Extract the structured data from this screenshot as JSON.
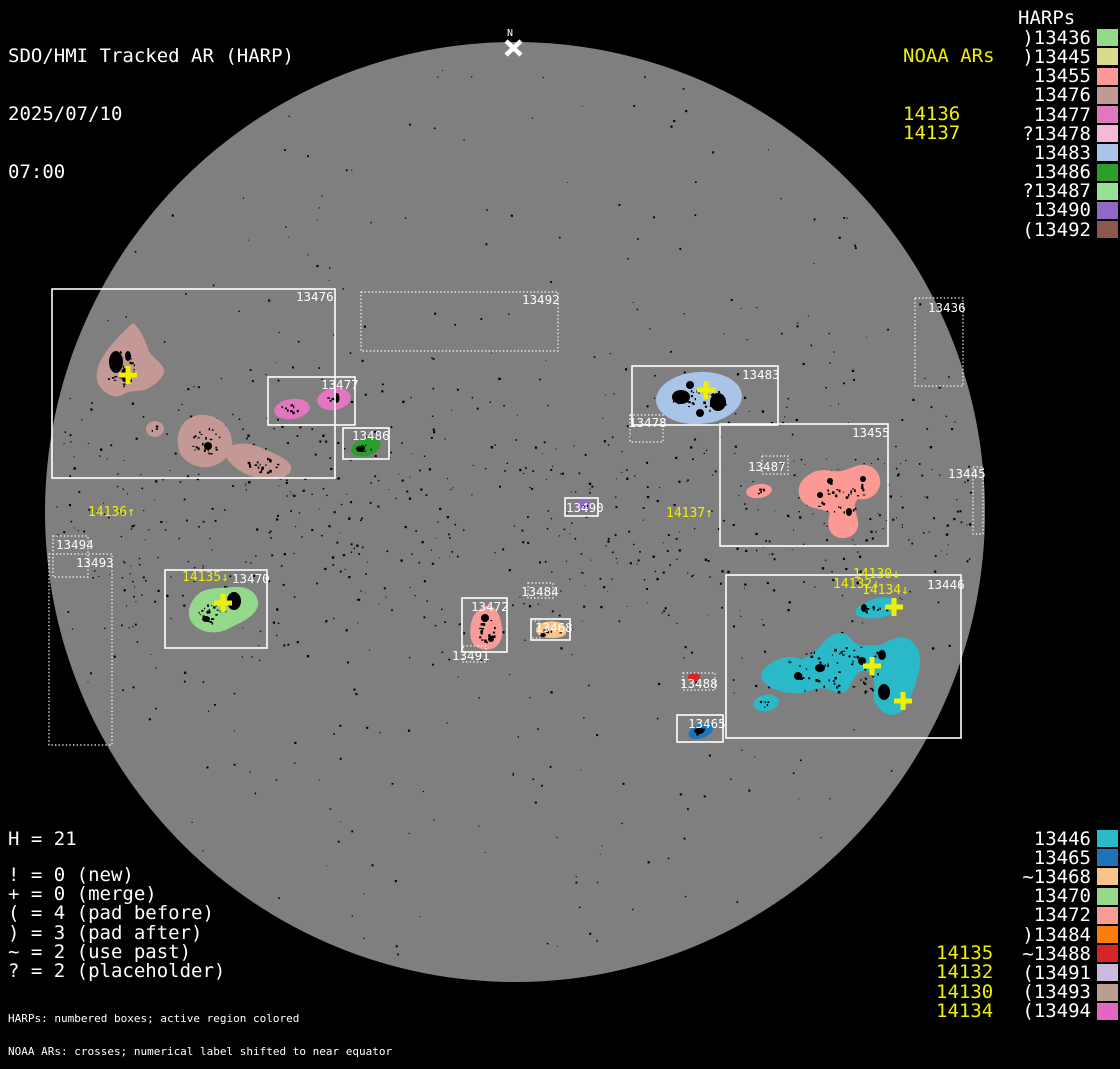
{
  "title": {
    "line1": "SDO/HMI Tracked AR (HARP)",
    "line2": "2025/07/10",
    "line3": "07:00"
  },
  "north_marker": {
    "label": "N"
  },
  "colors": {
    "background": "#000000",
    "disk": "#7f7f7f",
    "box_stroke": "#ffffff",
    "noaa_yellow": "#f0f000",
    "speckle": "#000000"
  },
  "noaa_top": {
    "header": "NOAA ARs",
    "items": [
      "14136",
      "14137"
    ]
  },
  "harps_top": {
    "header": "HARPs",
    "items": [
      {
        "prefix": ")",
        "id": "13436",
        "color": "#92db8a"
      },
      {
        "prefix": ")",
        "id": "13445",
        "color": "#d8da8c"
      },
      {
        "prefix": "",
        "id": "13455",
        "color": "#fb9a94"
      },
      {
        "prefix": "",
        "id": "13476",
        "color": "#c49995"
      },
      {
        "prefix": "",
        "id": "13477",
        "color": "#e077bf"
      },
      {
        "prefix": "?",
        "id": "13478",
        "color": "#f6b8d6"
      },
      {
        "prefix": "",
        "id": "13483",
        "color": "#aac4e8"
      },
      {
        "prefix": "",
        "id": "13486",
        "color": "#2b9e2b"
      },
      {
        "prefix": "?",
        "id": "13487",
        "color": "#98e093"
      },
      {
        "prefix": "",
        "id": "13490",
        "color": "#9168c4"
      },
      {
        "prefix": "(",
        "id": "13492",
        "color": "#8f5749"
      }
    ]
  },
  "harps_bottom": {
    "items": [
      {
        "prefix": "",
        "id": "13446",
        "color": "#2ab9c9"
      },
      {
        "prefix": "",
        "id": "13465",
        "color": "#1e74b9"
      },
      {
        "prefix": "~",
        "id": "13468",
        "color": "#f9c38c"
      },
      {
        "prefix": "",
        "id": "13470",
        "color": "#93d88b"
      },
      {
        "prefix": "",
        "id": "13472",
        "color": "#f99b96"
      },
      {
        "prefix": ")",
        "id": "13484",
        "color": "#fa7d0e"
      },
      {
        "prefix": "~",
        "id": "13488",
        "color": "#d42627"
      },
      {
        "prefix": "(",
        "id": "13491",
        "color": "#cabade"
      },
      {
        "prefix": "(",
        "id": "13493",
        "color": "#bd9c92"
      },
      {
        "prefix": "(",
        "id": "13494",
        "color": "#e466c4"
      }
    ]
  },
  "noaa_bottom": {
    "items": [
      "14135",
      "14132",
      "14130",
      "14134"
    ]
  },
  "stats": {
    "harp_count": "H = 21"
  },
  "legend": {
    "items": [
      "! = 0 (new)",
      "+ = 0 (merge)",
      "( = 4 (pad before)",
      ") = 3 (pad after)",
      "~ = 2 (use past)",
      "? = 2 (placeholder)"
    ]
  },
  "footnotes": {
    "line1": "HARPs: numbered boxes; active region colored",
    "line2": "NOAA ARs: crosses; numerical label shifted to near equator"
  },
  "disk": {
    "cx": 515,
    "cy": 512,
    "r": 470
  },
  "regions": [
    {
      "id": "13476",
      "label": "13476",
      "dotted": false,
      "box": [
        52,
        289,
        283,
        189
      ],
      "label_pos": [
        296,
        301
      ],
      "color": "#c49995",
      "blobs": [
        {
          "shape": "path",
          "d": "M133,323 C126,329 112,342 104,355 C96,367 94,380 101,388 C108,396 117,399 124,394 C132,389 141,393 149,388 C159,382 167,374 163,367 C158,359 150,356 148,349 C145,339 139,327 133,323 Z",
          "spots": {
            "cx": 120,
            "cy": 368,
            "rx": 16,
            "ry": 18,
            "n": 40
          },
          "patches": [
            [
              116,
              362,
              7,
              11
            ],
            [
              125,
              375,
              4,
              7
            ],
            [
              128,
              356,
              3,
              5
            ]
          ]
        },
        {
          "shape": "ellipse",
          "cx": 155,
          "cy": 429,
          "rx": 9,
          "ry": 8,
          "rot": 0,
          "spots": {
            "cx": 155,
            "cy": 429,
            "rx": 4,
            "ry": 4,
            "n": 4
          }
        },
        {
          "shape": "path",
          "d": "M187,420 C177,428 175,444 181,455 C187,464 201,470 213,466 C225,462 234,452 232,440 C230,427 220,417 206,415 C198,414 193,416 187,420 Z",
          "spots": {
            "cx": 205,
            "cy": 441,
            "rx": 16,
            "ry": 14,
            "n": 26
          },
          "patches": [
            [
              208,
              446,
              4,
              4
            ]
          ]
        },
        {
          "shape": "path",
          "d": "M228,448 C238,441 252,443 264,449 C278,455 293,461 291,470 C289,479 270,481 254,477 C240,473 228,463 226,456 Z",
          "spots": {
            "cx": 262,
            "cy": 464,
            "rx": 18,
            "ry": 8,
            "n": 22
          }
        }
      ]
    },
    {
      "id": "13477",
      "label": "13477",
      "dotted": false,
      "box": [
        268,
        377,
        87,
        48
      ],
      "label_pos": [
        321,
        389
      ],
      "color": "#e077bf",
      "blobs": [
        {
          "shape": "ellipse",
          "cx": 292,
          "cy": 409,
          "rx": 18,
          "ry": 10,
          "rot": -8,
          "spots": {
            "cx": 290,
            "cy": 408,
            "rx": 10,
            "ry": 4,
            "n": 8
          }
        },
        {
          "shape": "ellipse",
          "cx": 334,
          "cy": 399,
          "rx": 17,
          "ry": 11,
          "rot": -10,
          "spots": {
            "cx": 333,
            "cy": 398,
            "rx": 8,
            "ry": 5,
            "n": 6
          },
          "patches": [
            [
              337,
              398,
              2.5,
              5
            ]
          ]
        }
      ]
    },
    {
      "id": "13492",
      "label": "13492",
      "dotted": true,
      "box": [
        361,
        292,
        197,
        59
      ],
      "label_pos": [
        522,
        304
      ],
      "color": "#8f5749",
      "blobs": []
    },
    {
      "id": "13486",
      "label": "13486",
      "dotted": false,
      "box": [
        343,
        428,
        46,
        31
      ],
      "label_pos": [
        352,
        440
      ],
      "color": "#2b9e2b",
      "blobs": [
        {
          "shape": "ellipse",
          "cx": 366,
          "cy": 447,
          "rx": 15,
          "ry": 9,
          "rot": -15,
          "spots": {
            "cx": 363,
            "cy": 448,
            "rx": 8,
            "ry": 4,
            "n": 8
          },
          "patches": [
            [
              360,
              449,
              4,
              3
            ]
          ]
        }
      ]
    },
    {
      "id": "13483",
      "label": "13483",
      "dotted": false,
      "box": [
        632,
        366,
        146,
        59
      ],
      "label_pos": [
        742,
        379
      ],
      "color": "#aac4e8",
      "blobs": [
        {
          "shape": "ellipse",
          "cx": 699,
          "cy": 398,
          "rx": 43,
          "ry": 26,
          "rot": -4,
          "spots": {
            "cx": 698,
            "cy": 400,
            "rx": 28,
            "ry": 13,
            "n": 35
          },
          "patches": [
            [
              681,
              397,
              9,
              7
            ],
            [
              718,
              402,
              8,
              9
            ],
            [
              700,
              413,
              4,
              4
            ],
            [
              690,
              385,
              4,
              4
            ]
          ]
        }
      ]
    },
    {
      "id": "13478",
      "label": "13478",
      "dotted": true,
      "box": [
        630,
        415,
        33,
        27
      ],
      "label_pos": [
        629,
        427
      ],
      "color": "#f6b8d6",
      "blobs": []
    },
    {
      "id": "13455",
      "label": "13455",
      "dotted": false,
      "box": [
        720,
        424,
        168,
        122
      ],
      "label_pos": [
        852,
        437
      ],
      "color": "#fb9a94",
      "blobs": [
        {
          "shape": "ellipse",
          "cx": 759,
          "cy": 491,
          "rx": 13,
          "ry": 7,
          "rot": -8,
          "spots": {
            "cx": 758,
            "cy": 491,
            "rx": 8,
            "ry": 3,
            "n": 5
          }
        },
        {
          "shape": "path",
          "d": "M807,476 C797,483 796,496 804,503 C812,510 822,508 830,513 C827,522 827,533 837,537 C849,541 860,533 858,521 C856,511 852,505 858,499 C868,501 878,495 880,485 C882,473 872,463 860,465 C850,467 843,473 833,471 C823,469 814,470 807,476 Z",
          "spots": {
            "cx": 840,
            "cy": 495,
            "rx": 26,
            "ry": 22,
            "n": 30
          },
          "patches": [
            [
              830,
              481,
              3,
              3
            ],
            [
              849,
              512,
              3,
              4
            ],
            [
              863,
              479,
              3,
              3
            ],
            [
              820,
              495,
              3,
              3
            ]
          ]
        }
      ]
    },
    {
      "id": "13487",
      "label": "13487",
      "dotted": true,
      "box": [
        762,
        456,
        26,
        18
      ],
      "label_pos": [
        748,
        471
      ],
      "color": "#98e093",
      "blobs": []
    },
    {
      "id": "13490",
      "label": "13490",
      "dotted": false,
      "box": [
        565,
        498,
        33,
        18
      ],
      "label_pos": [
        566,
        512
      ],
      "color": "#9168c4",
      "blobs": [
        {
          "shape": "ellipse",
          "cx": 584,
          "cy": 505,
          "rx": 8,
          "ry": 5.5,
          "rot": 0,
          "spots": {
            "cx": 584,
            "cy": 505,
            "rx": 4,
            "ry": 3,
            "n": 3
          }
        }
      ]
    },
    {
      "id": "13436",
      "label": "13436",
      "dotted": true,
      "box": [
        915,
        298,
        48,
        88
      ],
      "label_pos": [
        928,
        312
      ],
      "color": "#92db8a",
      "blobs": []
    },
    {
      "id": "13445",
      "label": "13445",
      "dotted": true,
      "box": [
        973,
        467,
        10,
        67
      ],
      "label_pos": [
        948,
        478
      ],
      "color": "#d8da8c",
      "blobs": []
    },
    {
      "id": "13494",
      "label": "13494",
      "dotted": true,
      "box": [
        53,
        536,
        35,
        41
      ],
      "label_pos": [
        56,
        549
      ],
      "color": "#e466c4",
      "blobs": []
    },
    {
      "id": "13493",
      "label": "13493",
      "dotted": true,
      "box": [
        49,
        554,
        63,
        191
      ],
      "label_pos": [
        76,
        567
      ],
      "color": "#bd9c92",
      "blobs": []
    },
    {
      "id": "13470",
      "label": "13470",
      "dotted": false,
      "box": [
        165,
        570,
        102,
        78
      ],
      "label_pos": [
        232,
        583
      ],
      "color": "#93d88b",
      "blobs": [
        {
          "shape": "path",
          "d": "M201,592 C189,600 185,615 193,624 C201,633 216,635 228,629 C242,622 256,616 258,605 C259,594 249,586 235,587 C223,588 211,587 201,592 Z",
          "spots": {
            "cx": 212,
            "cy": 613,
            "rx": 16,
            "ry": 10,
            "n": 25
          },
          "patches": [
            [
              234,
              601,
              7,
              9
            ],
            [
              206,
              619,
              4,
              3
            ]
          ]
        }
      ]
    },
    {
      "id": "13472",
      "label": "13472",
      "dotted": false,
      "box": [
        462,
        598,
        45,
        54
      ],
      "label_pos": [
        471,
        611
      ],
      "color": "#f99b96",
      "blobs": [
        {
          "shape": "path",
          "d": "M479,610 C471,615 469,628 471,639 C473,647 481,651 491,649 C499,647 504,638 502,627 C500,615 497,607 489,606 C485,605 482,607 479,610 Z",
          "spots": {
            "cx": 486,
            "cy": 628,
            "rx": 9,
            "ry": 14,
            "n": 20
          },
          "patches": [
            [
              485,
              618,
              4,
              4
            ],
            [
              491,
              639,
              3,
              3
            ]
          ]
        }
      ]
    },
    {
      "id": "13484",
      "label": "13484",
      "dotted": true,
      "box": [
        528,
        583,
        25,
        15
      ],
      "label_pos": [
        521,
        596
      ],
      "color": "#fa7d0e",
      "blobs": []
    },
    {
      "id": "13468",
      "label": "13468",
      "dotted": false,
      "box": [
        531,
        619,
        39,
        21
      ],
      "box2": [
        531,
        621,
        9,
        17
      ],
      "label_pos": [
        535,
        632
      ],
      "color": "#f9c38c",
      "blobs": [
        {
          "shape": "path",
          "d": "M537,627 C540,622 550,620 558,622 C566,624 568,630 565,635 C560,639 544,639 539,635 C536,632 535,630 537,627 Z",
          "spots": {
            "cx": 550,
            "cy": 631,
            "rx": 10,
            "ry": 4,
            "n": 8
          },
          "patches": [
            [
              543,
              635,
              3,
              2
            ]
          ]
        }
      ]
    },
    {
      "id": "13491",
      "label": "13491",
      "dotted": true,
      "box": [
        463,
        646,
        23,
        16
      ],
      "label_pos": [
        452,
        660
      ],
      "color": "#cabade",
      "blobs": []
    },
    {
      "id": "13488",
      "label": "13488",
      "dotted": true,
      "box": [
        683,
        673,
        32,
        17
      ],
      "label_pos": [
        680,
        688
      ],
      "color": "#d42627",
      "blobs": [
        {
          "shape": "ellipse",
          "cx": 694,
          "cy": 677,
          "rx": 6,
          "ry": 4.5,
          "rot": 0
        }
      ]
    },
    {
      "id": "13465",
      "label": "13465",
      "dotted": false,
      "box": [
        677,
        715,
        46,
        27
      ],
      "label_pos": [
        688,
        728
      ],
      "color": "#1e74b9",
      "blobs": [
        {
          "shape": "ellipse",
          "cx": 701,
          "cy": 731,
          "rx": 13,
          "ry": 7,
          "rot": -20,
          "spots": {
            "cx": 700,
            "cy": 731,
            "rx": 7,
            "ry": 4,
            "n": 5
          },
          "patches": [
            [
              699,
              731,
              5,
              3
            ]
          ]
        }
      ]
    },
    {
      "id": "13446",
      "label": "13446",
      "dotted": false,
      "box": [
        726,
        575,
        235,
        163
      ],
      "label_pos": [
        927,
        589
      ],
      "color": "#2ab9c9",
      "blobs": [
        {
          "shape": "path",
          "d": "M861,605 C854,609 853,615 861,617 C871,620 885,618 893,613 C901,608 899,600 890,598 C880,596 869,600 861,605 Z",
          "spots": {
            "cx": 875,
            "cy": 608,
            "rx": 14,
            "ry": 6,
            "n": 10
          },
          "patches": [
            [
              864,
              608,
              3,
              4
            ]
          ]
        },
        {
          "shape": "path",
          "d": "M764,669 C772,660 786,655 798,658 C810,661 819,646 828,638 C837,630 846,632 851,639 C860,650 869,643 878,646 C888,641 899,635 906,638 C915,642 921,651 920,662 C919,676 914,690 908,702 C904,712 896,717 888,714 C878,710 872,701 874,691 C876,682 873,673 866,671 C858,669 853,679 849,688 C843,697 834,691 827,689 C817,686 809,693 799,693 C787,694 773,690 766,684 C760,679 760,674 764,669 Z",
          "spots": {
            "cx": 838,
            "cy": 670,
            "rx": 55,
            "ry": 26,
            "n": 70
          },
          "patches": [
            [
              884,
              692,
              6,
              8
            ],
            [
              862,
              661,
              4,
              4
            ],
            [
              820,
              668,
              5,
              4
            ],
            [
              798,
              676,
              4,
              4
            ],
            [
              882,
              655,
              4,
              5
            ]
          ]
        },
        {
          "shape": "ellipse",
          "cx": 766,
          "cy": 703,
          "rx": 13,
          "ry": 8,
          "rot": -10,
          "spots": {
            "cx": 765,
            "cy": 703,
            "rx": 7,
            "ry": 4,
            "n": 5
          }
        }
      ]
    }
  ],
  "noaa_marks": [
    {
      "label": "14136↑",
      "x": 88,
      "y": 516,
      "cross": [
        128,
        375
      ]
    },
    {
      "label": "14137↑",
      "x": 666,
      "y": 517,
      "cross": [
        706,
        390
      ]
    },
    {
      "label": "14135↓",
      "x": 182,
      "y": 581,
      "cross": [
        223,
        603
      ]
    },
    {
      "label": "14130↓",
      "x": 853,
      "y": 578,
      "cross": [
        894,
        607
      ]
    },
    {
      "label": "14132↓",
      "x": 833,
      "y": 588,
      "cross": [
        872,
        666
      ]
    },
    {
      "label": "14134↓",
      "x": 862,
      "y": 594,
      "cross": [
        903,
        701
      ]
    }
  ]
}
